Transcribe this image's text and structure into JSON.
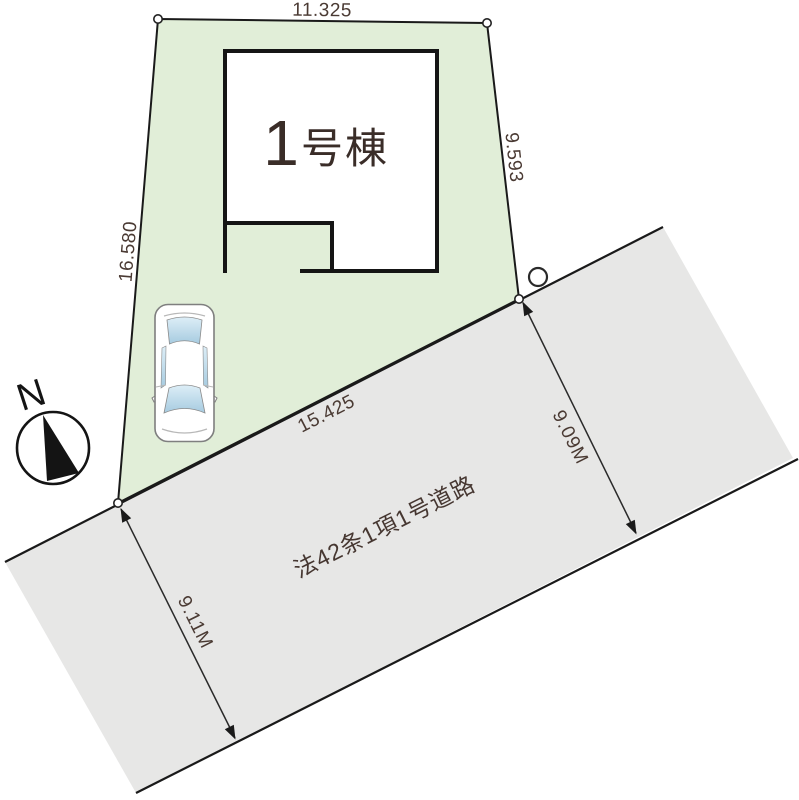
{
  "colors": {
    "plot_fill": "#e1eed8",
    "road_fill": "#e7e7e6",
    "line": "#1a1a1a"
  },
  "plot": {
    "dimensions": {
      "top": "11.325",
      "right": "9.593",
      "left": "16.580",
      "road_side": "15.425"
    }
  },
  "building": {
    "number": "1",
    "suffix": "号棟"
  },
  "road": {
    "name": "法42条1項1号道路",
    "width_upper": "9.09M",
    "width_lower": "9.11M"
  },
  "compass": {
    "north_label": "N"
  }
}
